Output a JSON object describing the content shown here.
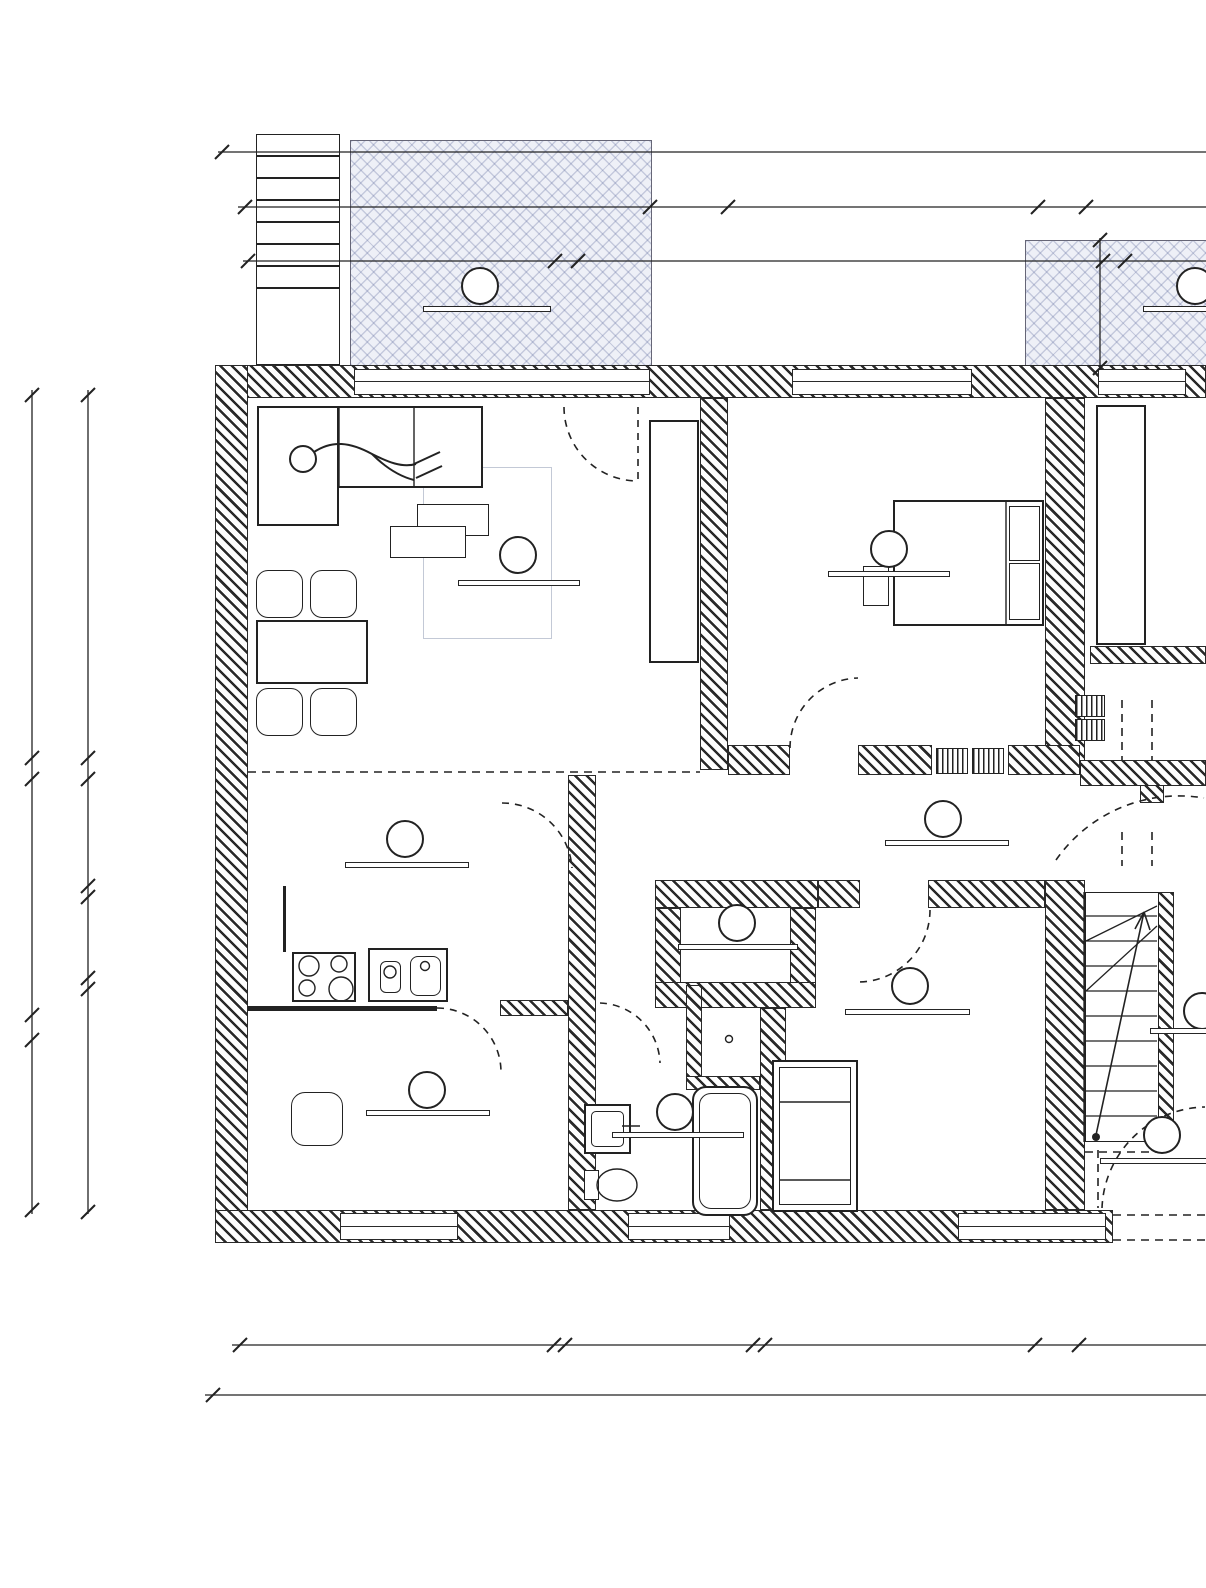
{
  "labels": {
    "am_gesamt_top": "AM I Gesamt",
    "im_ausbau_top1": "IM I Ausbau",
    "im_ausbau_top2": "IM I Ausbau",
    "im_ausbau_bottom": "IM I Ausbau",
    "am_gesamt_bottom": "AM I Gesamt",
    "im_ausbau_vert1": "IM I Ausbau",
    "im_ausbau_vert2": "IM I Ausbau",
    "wohnung01": "Wohnung 01",
    "dt": "DT",
    "wohnung_right": "Wohnung"
  },
  "dims": {
    "top_total": {
      "v": "18,92",
      "s": "5"
    },
    "row2": [
      {
        "v": "5,77",
        "s": "5"
      },
      {
        "v": "25",
        "s": "5"
      },
      {
        "v": "3,96",
        "s": "5"
      },
      {
        "v": "53"
      }
    ],
    "row3": [
      {
        "v": "3,97"
      },
      {
        "v": "27"
      },
      {
        "v": "6,87"
      },
      {
        "v": "28"
      }
    ],
    "terrace_height": {
      "v": "1,60"
    },
    "left_outer": [
      {
        "v": "4,53"
      },
      {
        "v": "26"
      },
      {
        "v": "2,83"
      },
      {
        "v": "14"
      },
      {
        "v": "2,47"
      }
    ],
    "left_inner": [
      {
        "v": "4,53"
      },
      {
        "v": "26"
      },
      {
        "v": "1,33",
        "s": "5"
      },
      {
        "v": "14"
      },
      {
        "v": "1,01",
        "s": "5"
      },
      {
        "v": "14"
      },
      {
        "v": "2,81"
      }
    ],
    "bottom_row": [
      {
        "v": "3,92"
      },
      {
        "v": "14"
      },
      {
        "v": "2,34",
        "s": "5"
      },
      {
        "v": "15"
      },
      {
        "v": "3,37"
      },
      {
        "v": "55"
      },
      {
        "v": "2,17",
        "s": "5"
      }
    ],
    "bottom_total": {
      "v": "20,99"
    }
  },
  "rooms": {
    "terrasse1": {
      "unit": "01",
      "name": "Terrasse",
      "area": "10.84m",
      "area_sup": "2",
      "suffix": " = 100%"
    },
    "terrasse2": {
      "unit": "02",
      "name": "Terrasse",
      "area": "06.57m",
      "area_sup": "2"
    },
    "wohnen": {
      "unit": "01",
      "name": "Wohnen",
      "area": "26.44m",
      "area_sup": "2"
    },
    "schlafen": {
      "unit": "01",
      "name": "Schlafen",
      "area": "17.22m",
      "area_sup": "2"
    },
    "kochen": {
      "unit": "01",
      "name": "Kochen",
      "area": "11.37m",
      "area_sup": "2"
    },
    "flurzone": {
      "unit": "01",
      "name": "Flurzone",
      "area": "10.81m",
      "area_sup": "2"
    },
    "abstell": {
      "unit": "01",
      "name": "Abstell",
      "area": "01.47m",
      "area_sup": "2"
    },
    "kind": {
      "unit": "01",
      "name": "Kind",
      "area": "12.81m",
      "area_sup": "2"
    },
    "arbeit": {
      "unit": "01",
      "name": "Arbeit",
      "area": "09.69m",
      "area_sup": "2"
    },
    "badezimmer": {
      "unit": "01",
      "name": "Badezimmer",
      "area": "05.96m",
      "area_sup": "2"
    },
    "flurbereich": {
      "unit": "01",
      "name": "Flurbereich",
      "area": "04."
    },
    "eingangsbereich": {
      "unit": "G",
      "name": "Eingangsbereich",
      "area": "02.46m",
      "area_sup": "2"
    }
  }
}
